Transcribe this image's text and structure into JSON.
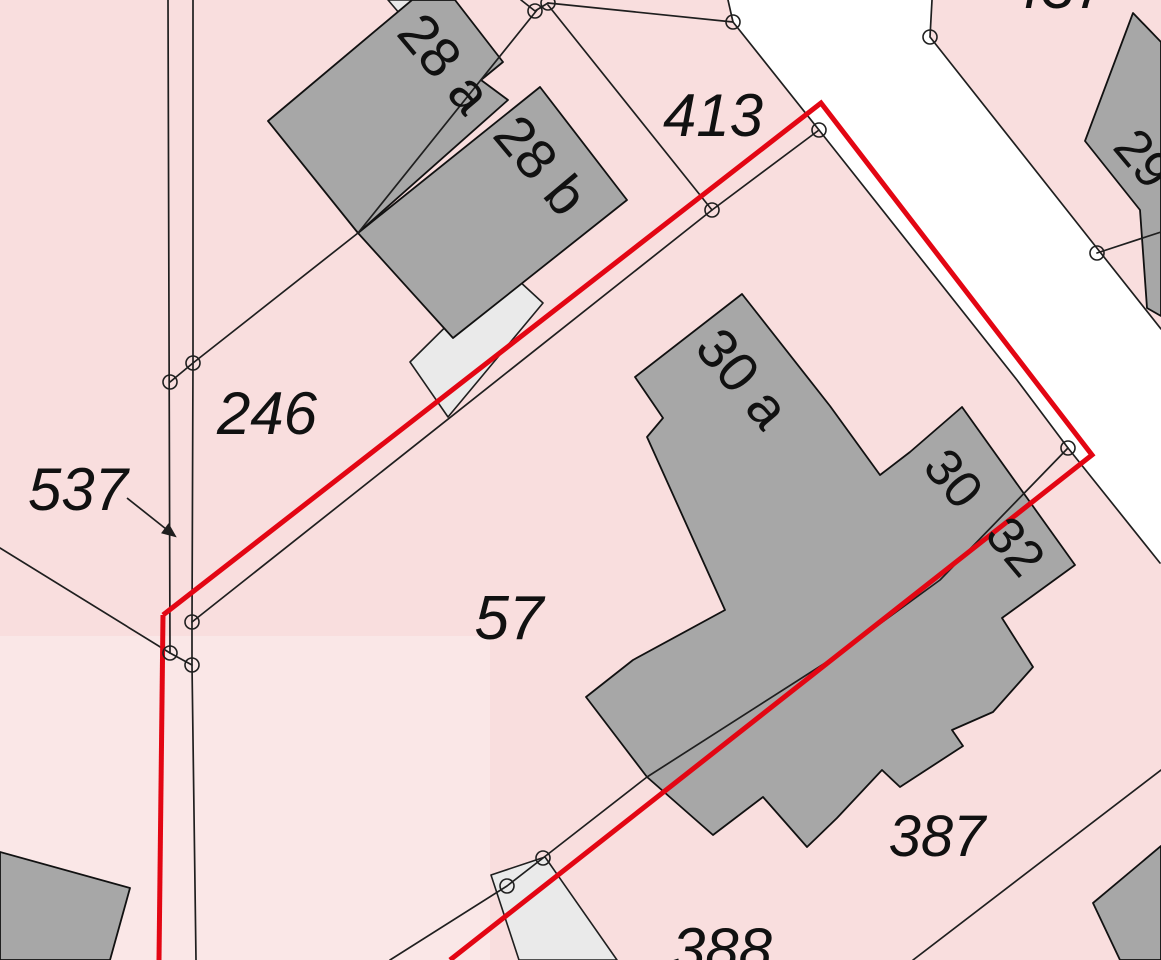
{
  "map": {
    "title": "cadastral-parcel-map",
    "colors": {
      "parcel_fill": "#f9dede",
      "parcel_fill_light": "#fbe9e9",
      "road_fill": "#ffffff",
      "building_fill": "#a7a7a7",
      "annex_fill": "#eaeaea",
      "boundary_line": "#1f1f1f",
      "highlight_red": "#e30613",
      "label_color": "#111111"
    },
    "parcel_labels": [
      {
        "id": "p537",
        "text": "537"
      },
      {
        "id": "p246",
        "text": "246"
      },
      {
        "id": "p413",
        "text": "413"
      },
      {
        "id": "p57",
        "text": "57"
      },
      {
        "id": "p387",
        "text": "387"
      },
      {
        "id": "p388",
        "text": "388"
      },
      {
        "id": "p437",
        "text": "437",
        "note": "partially visible at top edge"
      }
    ],
    "house_labels": [
      {
        "id": "h28a",
        "text": "28 a"
      },
      {
        "id": "h28b",
        "text": "28 b"
      },
      {
        "id": "h30a",
        "text": "30 a"
      },
      {
        "id": "h30",
        "text": "30"
      },
      {
        "id": "h32",
        "text": "32"
      },
      {
        "id": "h29",
        "text": "29"
      }
    ],
    "markers": {
      "symbol": "boundary-point-circle",
      "radius": 7,
      "points": [
        [
          535,
          11
        ],
        [
          548,
          3
        ],
        [
          733,
          22
        ],
        [
          819,
          130
        ],
        [
          712,
          210
        ],
        [
          930,
          37
        ],
        [
          1097,
          253
        ],
        [
          1068,
          448
        ],
        [
          193,
          363
        ],
        [
          170,
          382
        ],
        [
          192,
          622
        ],
        [
          170,
          653
        ],
        [
          192,
          665
        ],
        [
          543,
          858
        ],
        [
          507,
          886
        ]
      ]
    },
    "highlight": {
      "color": "#e30613",
      "width": 5,
      "outline_points_main": "163,615 821,103 1092,455 450,960",
      "outline_points_left": "163,615 159,960"
    }
  }
}
